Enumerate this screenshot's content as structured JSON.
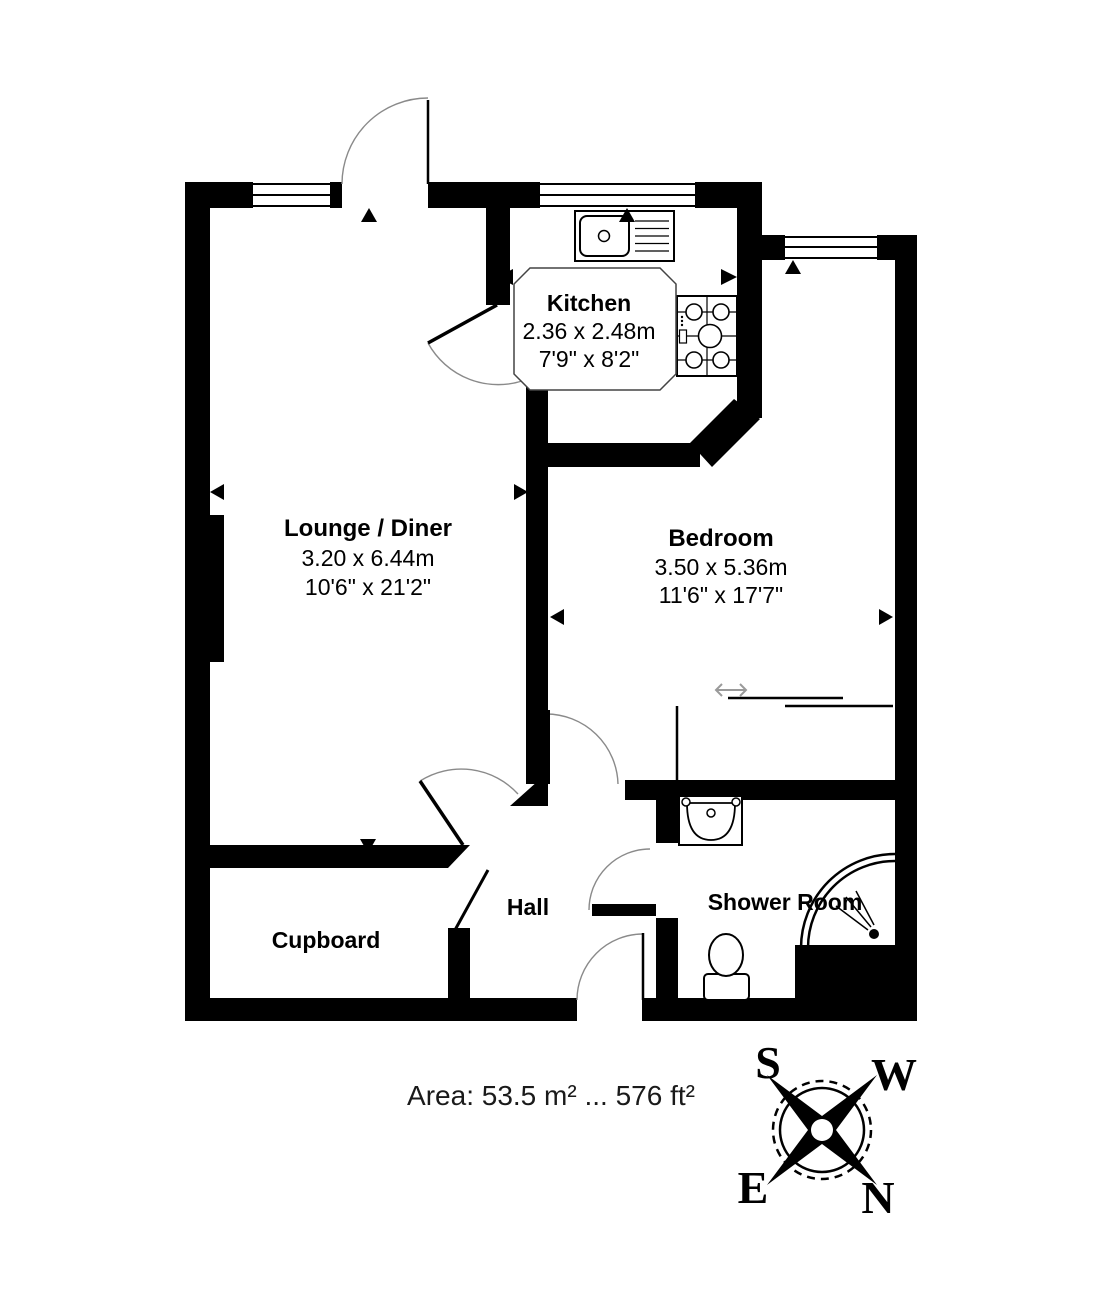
{
  "rooms": {
    "lounge": {
      "name": "Lounge / Diner",
      "metric": "3.20 x 6.44m",
      "imperial": "10'6\" x 21'2\""
    },
    "kitchen": {
      "name": "Kitchen",
      "metric": "2.36 x 2.48m",
      "imperial": "7'9\" x 8'2\""
    },
    "bedroom": {
      "name": "Bedroom",
      "metric": "3.50 x 5.36m",
      "imperial": "11'6\" x 17'7\""
    },
    "hall": {
      "name": "Hall"
    },
    "cupboard": {
      "name": "Cupboard"
    },
    "shower_room": {
      "name": "Shower Room"
    }
  },
  "area_text": "Area: 53.5 m² ... 576 ft²",
  "compass": {
    "s": "S",
    "w": "W",
    "e": "E",
    "n": "N"
  },
  "colors": {
    "wall": "#000000",
    "background": "#ffffff",
    "door_arc": "#8a8a8a"
  }
}
